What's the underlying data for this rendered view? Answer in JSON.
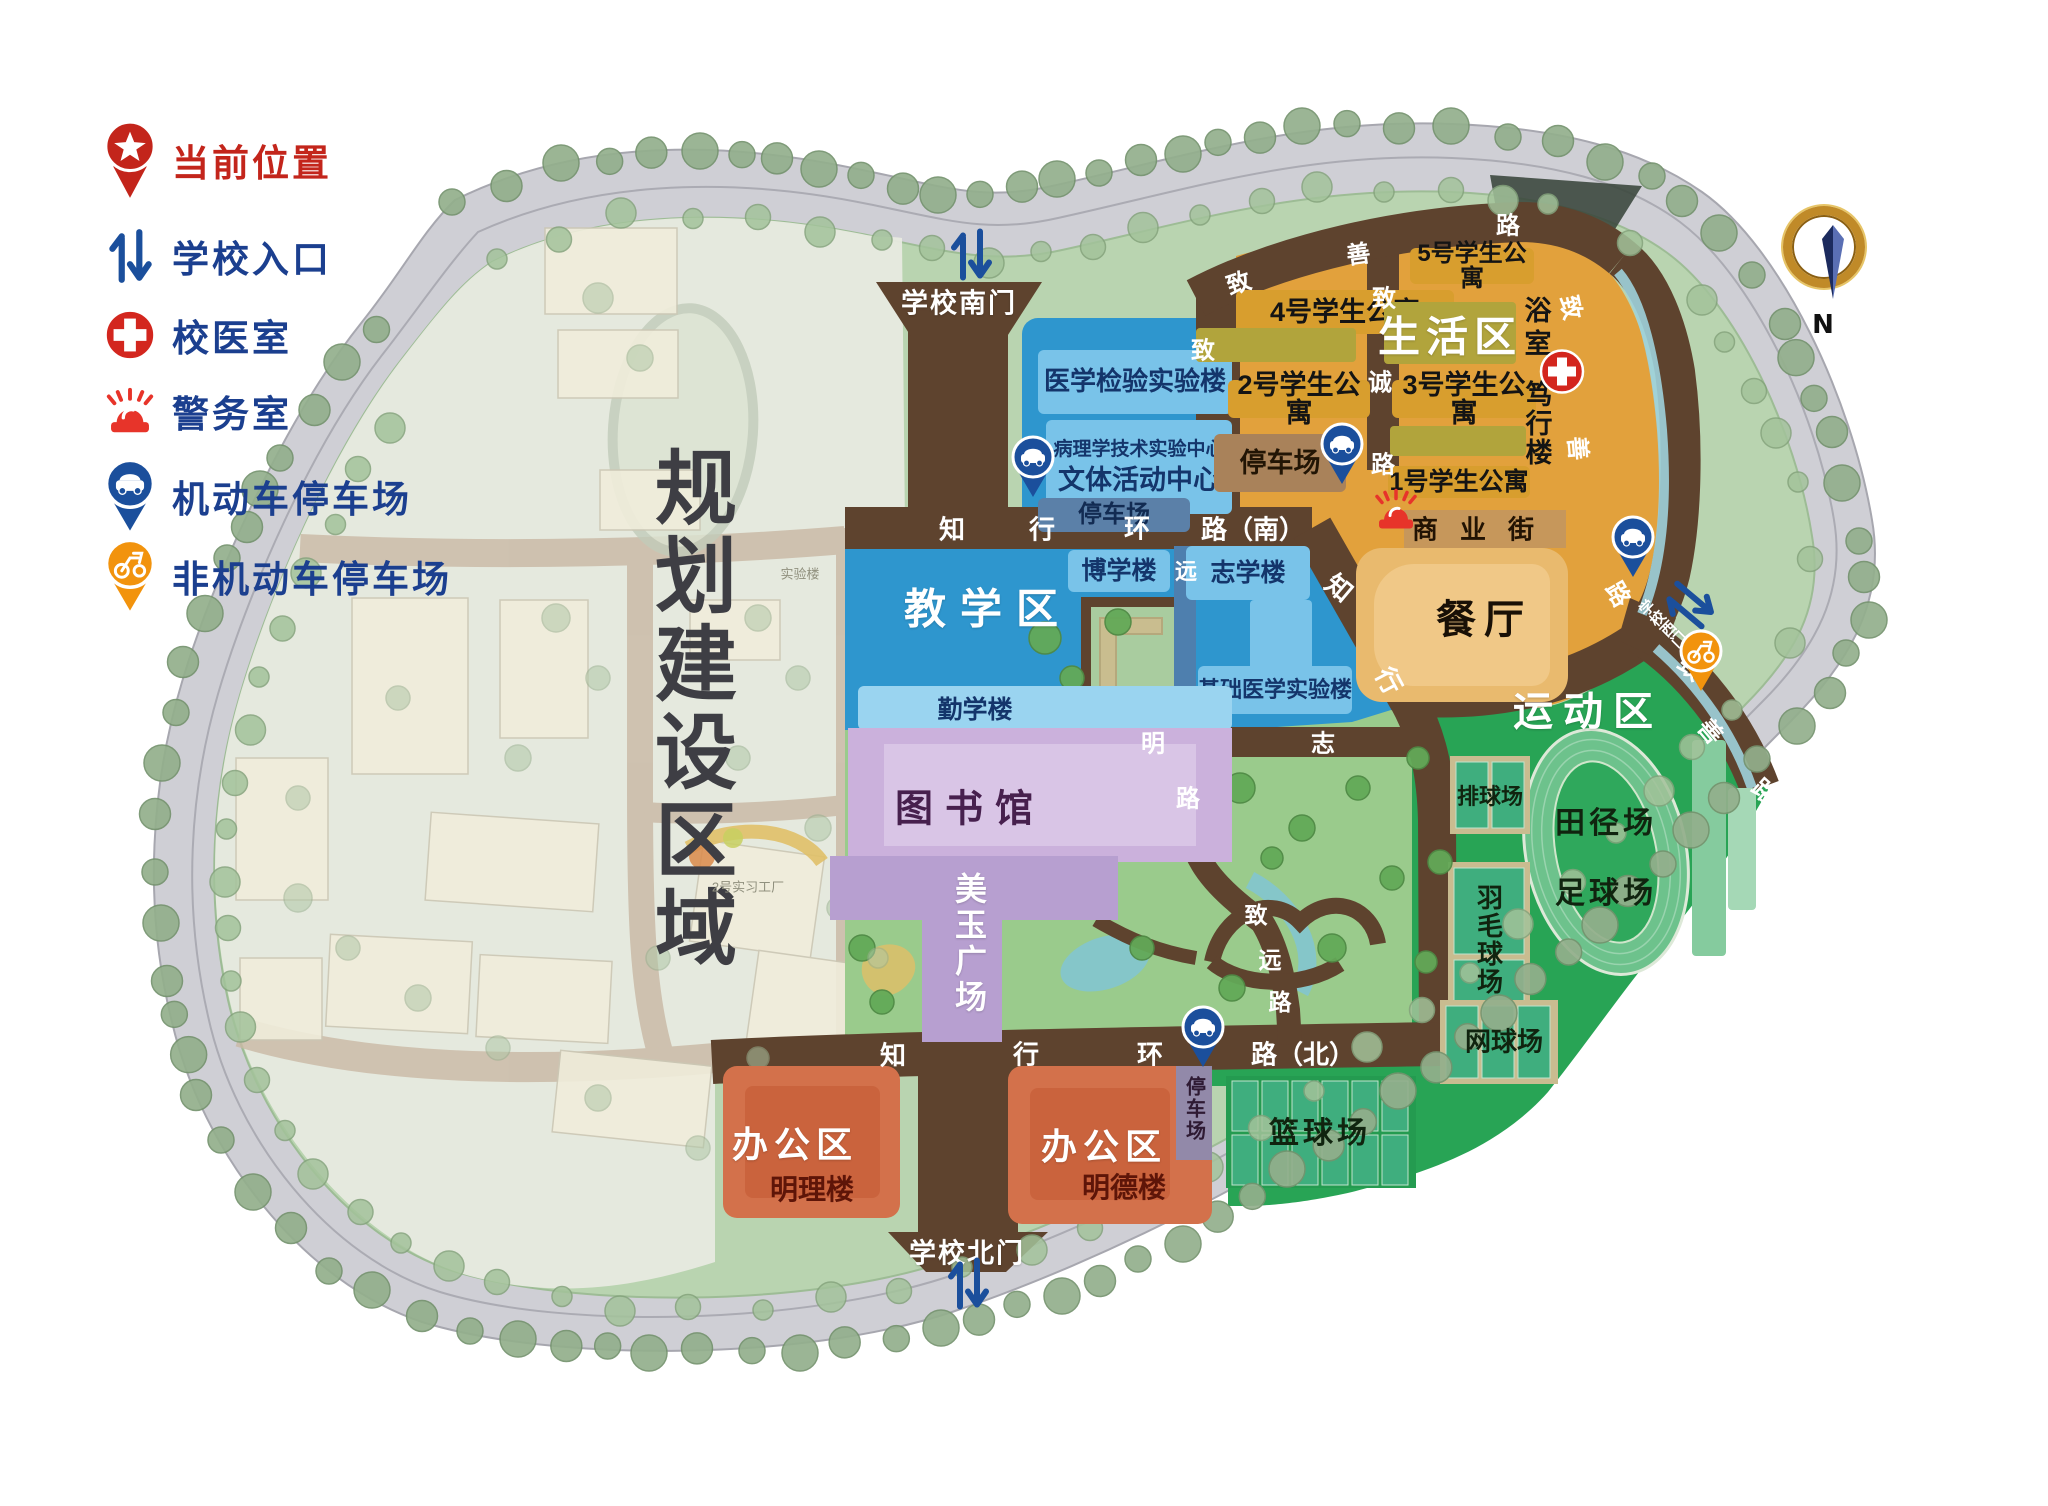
{
  "legend": {
    "items": [
      {
        "icon": "location-pin-icon",
        "label": "当前位置",
        "color": "#C3251B"
      },
      {
        "icon": "gate-arrows-icon",
        "label": "学校入口",
        "color": "#1B3F8F"
      },
      {
        "icon": "medical-cross-icon",
        "label": "校医室",
        "color": "#1B3F8F"
      },
      {
        "icon": "siren-icon",
        "label": "警务室",
        "color": "#1B3F8F"
      },
      {
        "icon": "car-parking-pin-icon",
        "label": "机动车停车场",
        "color": "#1B3F8F"
      },
      {
        "icon": "scooter-parking-pin-icon",
        "label": "非机动车停车场",
        "color": "#1B3F8F"
      }
    ]
  },
  "compass": {
    "north_label": "N"
  },
  "zones": {
    "planning": "规划建设区域",
    "teaching": "教学区",
    "living": "生活区",
    "sports": "运动区",
    "office": "办公区",
    "plaza": "美玉广场"
  },
  "gates": {
    "south": "学校南门",
    "north": "学校北门",
    "west": "学校西门"
  },
  "buildings": {
    "med_lab": "医学检验实验楼",
    "pathology": "病理学技术实验中心",
    "cultural": "文体活动中心",
    "parking": "停车场",
    "boxue": "博学楼",
    "zhixue": "志学楼",
    "basic_med": "基础医学实验楼",
    "qinxue": "勤学楼",
    "library": "图书馆",
    "apt5": "5号学生公寓",
    "apt4": "4号学生公寓",
    "apt3": "3号学生公寓",
    "apt2": "2号学生公寓",
    "apt1": "1号学生公寓",
    "bath": "浴室",
    "duxing": "笃行楼",
    "dining": "餐厅",
    "mingli": "明理楼",
    "mingde": "明德楼"
  },
  "sports": {
    "volleyball": "排球场",
    "badminton": "羽毛球场",
    "tennis": "网球场",
    "basketball": "篮球场",
    "track": "田径场",
    "football": "足球场"
  },
  "faded": {
    "lab": "实验楼",
    "factory": "2号实习工厂"
  },
  "roads": {
    "labels": [
      {
        "t": "知",
        "x": 952,
        "y": 528
      },
      {
        "t": "行",
        "x": 1042,
        "y": 528
      },
      {
        "t": "环",
        "x": 1137,
        "y": 527
      },
      {
        "t": "路（南）",
        "x": 1253,
        "y": 528
      },
      {
        "t": "知",
        "x": 1340,
        "y": 587,
        "rot": 40
      },
      {
        "t": "行",
        "x": 1390,
        "y": 680,
        "rot": 62
      },
      {
        "t": "远",
        "x": 1186,
        "y": 570,
        "s": 22
      },
      {
        "t": "明",
        "x": 1153,
        "y": 741,
        "s": 24
      },
      {
        "t": "志",
        "x": 1323,
        "y": 741,
        "s": 24
      },
      {
        "t": "路",
        "x": 1188,
        "y": 796,
        "s": 24
      },
      {
        "t": "致",
        "x": 1256,
        "y": 913,
        "s": 23
      },
      {
        "t": "远",
        "x": 1270,
        "y": 958,
        "s": 23
      },
      {
        "t": "路",
        "x": 1280,
        "y": 1000,
        "s": 23
      },
      {
        "t": "知",
        "x": 893,
        "y": 1054
      },
      {
        "t": "行",
        "x": 1026,
        "y": 1053
      },
      {
        "t": "环",
        "x": 1150,
        "y": 1053
      },
      {
        "t": "路（北）",
        "x": 1303,
        "y": 1053
      },
      {
        "t": "致",
        "x": 1203,
        "y": 348,
        "s": 24
      },
      {
        "t": "致",
        "x": 1384,
        "y": 296,
        "s": 24
      },
      {
        "t": "诚",
        "x": 1380,
        "y": 380,
        "s": 24
      },
      {
        "t": "路",
        "x": 1383,
        "y": 462,
        "s": 24
      },
      {
        "t": "致",
        "x": 1238,
        "y": 281,
        "rot": -18,
        "s": 24
      },
      {
        "t": "善",
        "x": 1358,
        "y": 252,
        "rot": -8,
        "s": 24
      },
      {
        "t": "路",
        "x": 1508,
        "y": 223,
        "rot": 0,
        "s": 24
      },
      {
        "t": "致",
        "x": 1573,
        "y": 307,
        "rot": 78,
        "s": 24
      },
      {
        "t": "善",
        "x": 1580,
        "y": 448,
        "rot": 85,
        "s": 24
      },
      {
        "t": "路",
        "x": 1620,
        "y": 593,
        "rot": 60,
        "s": 24
      },
      {
        "t": "致",
        "x": 1692,
        "y": 666,
        "rot": 40,
        "s": 24
      },
      {
        "t": "善",
        "x": 1712,
        "y": 730,
        "rot": 50,
        "s": 24
      },
      {
        "t": "路",
        "x": 1766,
        "y": 790,
        "rot": 42,
        "s": 24
      },
      {
        "t": "商",
        "x": 1425,
        "y": 528,
        "c": "#221303"
      },
      {
        "t": "业",
        "x": 1473,
        "y": 528,
        "c": "#221303"
      },
      {
        "t": "街",
        "x": 1521,
        "y": 528,
        "c": "#221303"
      }
    ]
  },
  "pins": [
    {
      "type": "car-parking-pin",
      "x": 1033,
      "y": 458
    },
    {
      "type": "car-parking-pin",
      "x": 1342,
      "y": 445
    },
    {
      "type": "car-parking-pin",
      "x": 1633,
      "y": 538
    },
    {
      "type": "car-parking-pin",
      "x": 1203,
      "y": 1028
    },
    {
      "type": "scooter-parking-pin",
      "x": 1701,
      "y": 652
    },
    {
      "type": "medical-cross",
      "x": 1562,
      "y": 374
    },
    {
      "type": "siren",
      "x": 1396,
      "y": 512
    },
    {
      "type": "gate-arrows",
      "x": 971,
      "y": 257
    },
    {
      "type": "gate-arrows",
      "x": 968,
      "y": 1286
    },
    {
      "type": "gate-arrows",
      "x": 1691,
      "y": 607,
      "rot": -50
    }
  ]
}
